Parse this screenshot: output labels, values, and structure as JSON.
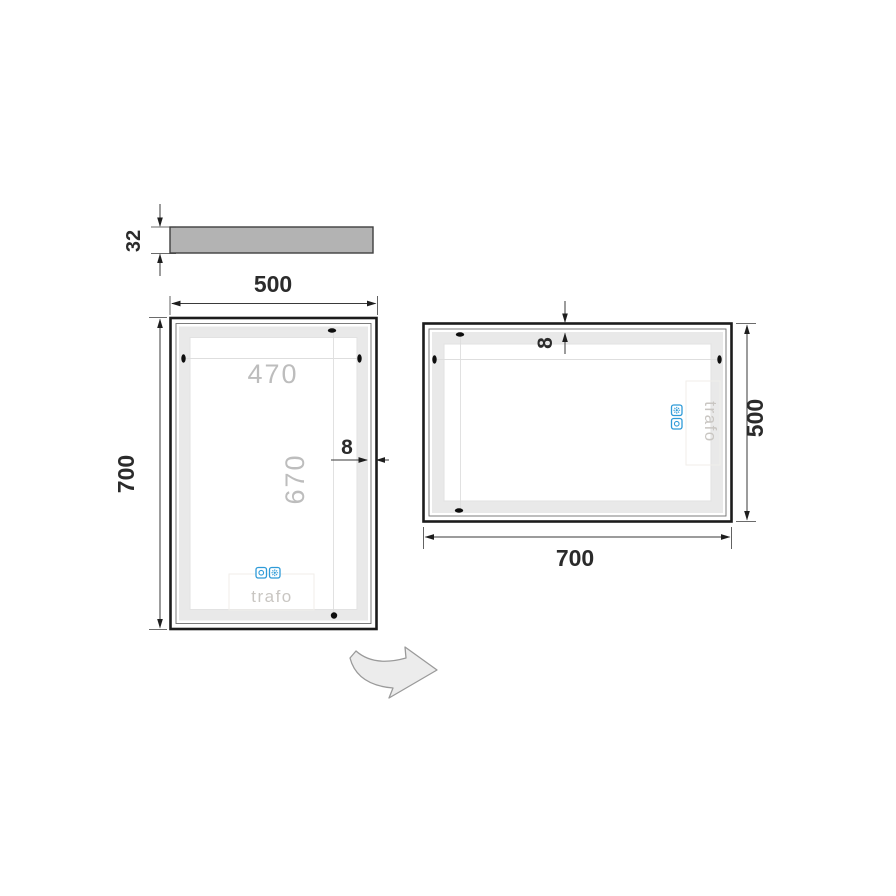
{
  "colors": {
    "frame": "#1c1c1c",
    "dimension_text": "#2b2b2b",
    "dimension_line": "#3a3a3a",
    "lit_area_text": "#bdbdbd",
    "led_band": "#e9e9e9",
    "profile_fill": "#b3b3b3",
    "sensor_blue": "#2f9bd8",
    "rotate_arrow_fill": "#ececec"
  },
  "profile_view": {
    "thickness": "32"
  },
  "portrait_view": {
    "width": "500",
    "height": "700",
    "lit_width": "470",
    "lit_height": "670",
    "edge_gap": "8",
    "transformer": "trafo"
  },
  "landscape_view": {
    "width": "700",
    "height": "500",
    "edge_gap": "8",
    "transformer": "trafo"
  },
  "icons": {
    "touch_ring": "touch-switch-ring-icon",
    "touch_gear": "touch-light-gear-icon",
    "rotate": "rotate-arrow-icon"
  }
}
